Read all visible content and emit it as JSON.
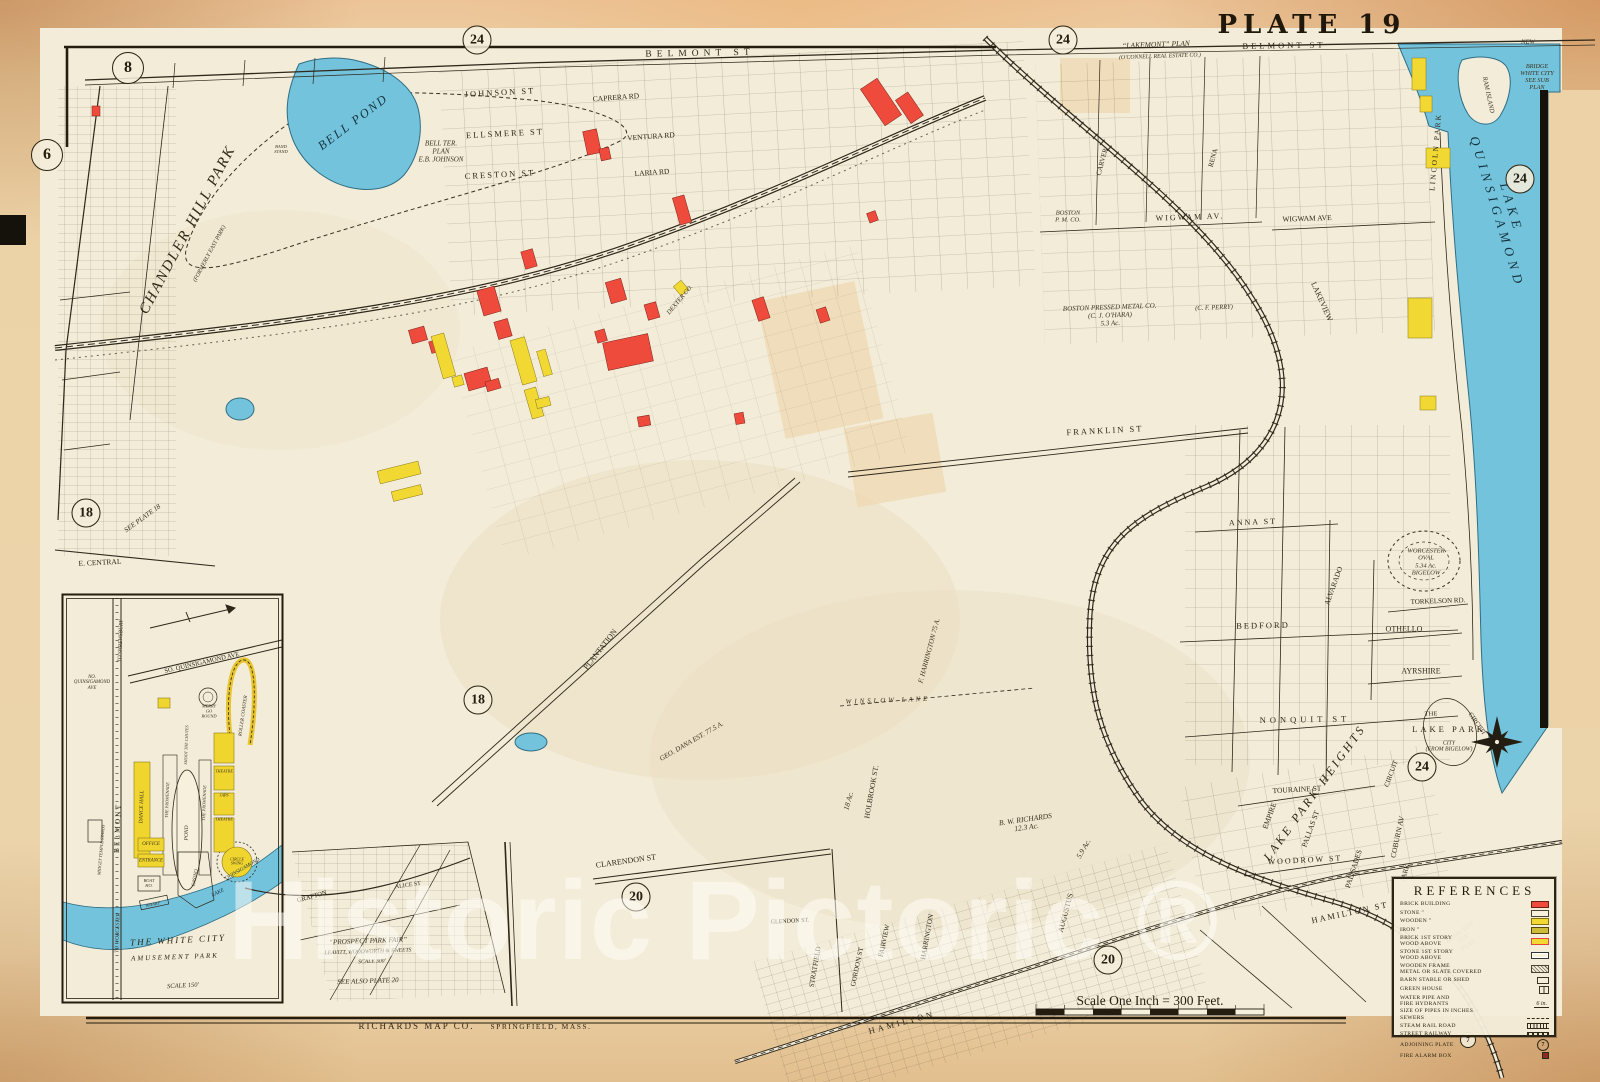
{
  "title": {
    "plate": "PLATE 19"
  },
  "watermark": "Historic Pictoric ®",
  "footer": {
    "publisher": "RICHARDS MAP CO.",
    "publisher_city": "SPRINGFIELD, MASS.",
    "scale": "Scale One Inch = 300 Feet."
  },
  "colors": {
    "paper": "#ecd2a6",
    "map_cream": "#f2ecd9",
    "water": "#74c3dc",
    "brick_red": "#ee4b3c",
    "wood_yellow": "#f2d832",
    "ink": "#2e271a"
  },
  "circled_plate_numbers": [
    {
      "n": "8",
      "x": 128,
      "y": 68,
      "d": 30
    },
    {
      "n": "6",
      "x": 47,
      "y": 155,
      "d": 30
    },
    {
      "n": "24",
      "x": 477,
      "y": 40,
      "d": 27
    },
    {
      "n": "24",
      "x": 1063,
      "y": 40,
      "d": 27
    },
    {
      "n": "24",
      "x": 1520,
      "y": 179,
      "d": 27
    },
    {
      "n": "18",
      "x": 86,
      "y": 513,
      "d": 27
    },
    {
      "n": "18",
      "x": 478,
      "y": 700,
      "d": 27
    },
    {
      "n": "20",
      "x": 636,
      "y": 897,
      "d": 27
    },
    {
      "n": "20",
      "x": 1108,
      "y": 960,
      "d": 27
    },
    {
      "n": "24",
      "x": 1422,
      "y": 767,
      "d": 27
    },
    {
      "n": "7",
      "x": 1468,
      "y": 1040,
      "d": 14
    }
  ],
  "legend": {
    "title": "REFERENCES",
    "plate_badge": "7",
    "pipe_text": "6 in.",
    "rows": [
      {
        "label": "BRICK BUILDING",
        "swatch": "brick"
      },
      {
        "label": "STONE ″",
        "swatch": "stone"
      },
      {
        "label": "WOODEN ″",
        "swatch": "wood"
      },
      {
        "label": "IRON ″",
        "swatch": "iron"
      },
      {
        "label": "BRICK 1ST STORY\nWOOD ABOVE",
        "swatch": "brick1"
      },
      {
        "label": "STONE 1ST STORY\nWOOD ABOVE",
        "swatch": "stone1"
      },
      {
        "label": "WOODEN FRAME\nMETAL OR SLATE COVERED",
        "swatch": "metal"
      },
      {
        "label": "BARN STABLE OR SHED",
        "swatch": "barn"
      },
      {
        "label": "GREEN HOUSE",
        "swatch": "greenhouse"
      },
      {
        "label": "WATER PIPE AND\nFIRE HYDRANTS\nSIZE OF PIPES IN INCHES",
        "swatch": "pipe"
      },
      {
        "label": "SEWERS",
        "swatch": "sewer"
      },
      {
        "label": "STEAM RAIL ROAD",
        "swatch": "steamrr"
      },
      {
        "label": "STREET RAILWAY",
        "swatch": "streetry"
      },
      {
        "label": "ADJOINING PLATE",
        "swatch": "plate"
      },
      {
        "label": "FIRE ALARM BOX",
        "swatch": "alarm"
      }
    ]
  },
  "labels": [
    {
      "t": "BELMONT ST",
      "x": 700,
      "y": 54,
      "r": -1,
      "s": 9.5,
      "c": "street",
      "sp": 5
    },
    {
      "t": "BELMONT ST",
      "x": 1284,
      "y": 46,
      "r": -1,
      "s": 8.5,
      "c": "street",
      "sp": 3
    },
    {
      "t": "JOHNSON ST",
      "x": 500,
      "y": 93,
      "r": -3,
      "s": 8.5,
      "c": "street",
      "sp": 2
    },
    {
      "t": "ELLSMERE ST",
      "x": 505,
      "y": 134,
      "r": -3,
      "s": 8.5,
      "c": "street",
      "sp": 2
    },
    {
      "t": "CRESTON ST",
      "x": 500,
      "y": 175,
      "r": -3,
      "s": 8.5,
      "c": "street",
      "sp": 2
    },
    {
      "t": "CAPRERA RD",
      "x": 616,
      "y": 98,
      "r": -4,
      "s": 7.5,
      "c": "street"
    },
    {
      "t": "VENTURA RD",
      "x": 651,
      "y": 137,
      "r": -4,
      "s": 7.5,
      "c": "street"
    },
    {
      "t": "LARIA RD",
      "x": 652,
      "y": 173,
      "r": -4,
      "s": 7.5,
      "c": "street"
    },
    {
      "t": "CARVER",
      "x": 1103,
      "y": 162,
      "r": -75,
      "s": 7,
      "c": "street"
    },
    {
      "t": "RENA",
      "x": 1214,
      "y": 158,
      "r": -75,
      "s": 7,
      "c": "street"
    },
    {
      "t": "WIGWAM AV.",
      "x": 1190,
      "y": 218,
      "r": -2,
      "s": 8,
      "c": "street",
      "sp": 2
    },
    {
      "t": "WIGWAM AVE",
      "x": 1307,
      "y": 219,
      "r": -2,
      "s": 7.5,
      "c": "street"
    },
    {
      "t": "LAKEVIEW",
      "x": 1321,
      "y": 302,
      "r": 66,
      "s": 8,
      "c": "street"
    },
    {
      "t": "FRANKLIN ST",
      "x": 1105,
      "y": 431,
      "r": -3,
      "s": 8.5,
      "c": "street",
      "sp": 2
    },
    {
      "t": "ANNA ST",
      "x": 1253,
      "y": 523,
      "r": -2,
      "s": 8,
      "c": "street",
      "sp": 2
    },
    {
      "t": "BEDFORD",
      "x": 1263,
      "y": 626,
      "r": -1,
      "s": 8.5,
      "c": "street",
      "sp": 2
    },
    {
      "t": "OTHELLO",
      "x": 1404,
      "y": 630,
      "r": 0,
      "s": 8,
      "c": "street"
    },
    {
      "t": "AYRSHIRE",
      "x": 1421,
      "y": 672,
      "r": 0,
      "s": 8,
      "c": "street"
    },
    {
      "t": "TORKELSON RD.",
      "x": 1438,
      "y": 602,
      "r": -2,
      "s": 7,
      "c": "street"
    },
    {
      "t": "NONQUIT ST",
      "x": 1305,
      "y": 720,
      "r": -1,
      "s": 8.5,
      "c": "street",
      "sp": 4
    },
    {
      "t": "TOURAINE ST",
      "x": 1297,
      "y": 790,
      "r": -3,
      "s": 7.5,
      "c": "street"
    },
    {
      "t": "WOODROW ST",
      "x": 1305,
      "y": 861,
      "r": -3,
      "s": 8,
      "c": "street",
      "sp": 2
    },
    {
      "t": "HAMILTON ST",
      "x": 1350,
      "y": 913,
      "r": -12,
      "s": 8.5,
      "c": "street",
      "sp": 2
    },
    {
      "t": "HAMILTON",
      "x": 902,
      "y": 1023,
      "r": -15,
      "s": 8.5,
      "c": "street",
      "sp": 3
    },
    {
      "t": "CLARENDON ST",
      "x": 626,
      "y": 862,
      "r": -8,
      "s": 8,
      "c": "street"
    },
    {
      "t": "E. CENTRAL",
      "x": 100,
      "y": 563,
      "r": -3,
      "s": 7.5,
      "c": "street"
    },
    {
      "t": "PLANTATION",
      "x": 601,
      "y": 650,
      "r": -52,
      "s": 8,
      "c": "street"
    },
    {
      "t": "HOLBROOK ST.",
      "x": 872,
      "y": 792,
      "r": -80,
      "s": 7.5,
      "c": "street"
    },
    {
      "t": "AUGUSTUS",
      "x": 1066,
      "y": 913,
      "r": -75,
      "s": 7.5,
      "c": "street"
    },
    {
      "t": "GORDON ST",
      "x": 858,
      "y": 967,
      "r": -78,
      "s": 7,
      "c": "street"
    },
    {
      "t": "FAIRVIEW",
      "x": 885,
      "y": 941,
      "r": -78,
      "s": 7,
      "c": "street"
    },
    {
      "t": "HARRINGTON",
      "x": 928,
      "y": 937,
      "r": -80,
      "s": 7,
      "c": "street"
    },
    {
      "t": "STRATFIELD",
      "x": 816,
      "y": 967,
      "r": -80,
      "s": 7,
      "c": "street"
    },
    {
      "t": "GLENDON ST.",
      "x": 790,
      "y": 922,
      "r": -3,
      "s": 6,
      "c": "street"
    },
    {
      "t": "EMPIRE",
      "x": 1270,
      "y": 816,
      "r": -70,
      "s": 7.5,
      "c": "street"
    },
    {
      "t": "PALLAS ST",
      "x": 1311,
      "y": 829,
      "r": -70,
      "s": 7.5,
      "c": "street"
    },
    {
      "t": "PALISADES",
      "x": 1354,
      "y": 869,
      "r": -72,
      "s": 7.5,
      "c": "street"
    },
    {
      "t": "COBURN AV",
      "x": 1398,
      "y": 837,
      "r": -78,
      "s": 7.5,
      "c": "street"
    },
    {
      "t": "CIRCUIT",
      "x": 1392,
      "y": 774,
      "r": -70,
      "s": 7,
      "c": "street"
    },
    {
      "t": "PARK",
      "x": 1406,
      "y": 873,
      "r": -75,
      "s": 7,
      "c": "street"
    },
    {
      "t": "ALVARADO",
      "x": 1334,
      "y": 586,
      "r": -70,
      "s": 7.5,
      "c": "street"
    },
    {
      "t": "LAKE PARK HEIGHTS",
      "x": 1315,
      "y": 793,
      "r": -54,
      "s": 12,
      "c": "area",
      "sp": 3
    },
    {
      "t": "LAKE PARK",
      "x": 1449,
      "y": 730,
      "r": 0,
      "s": 8.5,
      "c": "street",
      "sp": 3
    },
    {
      "t": "CITY\n(FROM BIGELOW)",
      "x": 1449,
      "y": 747,
      "r": 0,
      "s": 5.8,
      "c": "note"
    },
    {
      "t": "THE",
      "x": 1431,
      "y": 714,
      "r": 0,
      "s": 6.5,
      "c": "street"
    },
    {
      "t": "CIRCUIT",
      "x": 1477,
      "y": 724,
      "r": 55,
      "s": 6.5,
      "c": "street"
    },
    {
      "t": "WORCESTER\nOVAL\n5.34 Ac.\nBIGELOW",
      "x": 1426,
      "y": 562,
      "r": 0,
      "s": 6.5,
      "c": "note"
    },
    {
      "t": "BOSTON PRESSED METAL CO.\n(C. J. O'HARA)\n5.3 Ac.",
      "x": 1110,
      "y": 316,
      "r": -2,
      "s": 7,
      "c": "note"
    },
    {
      "t": "(C. F. PERRY)",
      "x": 1214,
      "y": 308,
      "r": -2,
      "s": 6.5,
      "c": "note"
    },
    {
      "t": "BOSTON\nP. M. CO.",
      "x": 1068,
      "y": 217,
      "r": 0,
      "s": 6.5,
      "c": "note"
    },
    {
      "t": "WINSLOW LANE",
      "x": 888,
      "y": 701,
      "r": -2,
      "s": 6.8,
      "c": "note",
      "sp": 3
    },
    {
      "t": "F. HARRINGTON  75 A.",
      "x": 930,
      "y": 651,
      "r": -75,
      "s": 7,
      "c": "note"
    },
    {
      "t": "GEO. DANA EST.  77.5 A.",
      "x": 692,
      "y": 742,
      "r": -30,
      "s": 7,
      "c": "note"
    },
    {
      "t": "18 Ac.",
      "x": 849,
      "y": 801,
      "r": -75,
      "s": 7.5,
      "c": "note"
    },
    {
      "t": "B. W. RICHARDS\n12.3 Ac.",
      "x": 1026,
      "y": 824,
      "r": -8,
      "s": 7.5,
      "c": "note"
    },
    {
      "t": "5.9 Ac.",
      "x": 1084,
      "y": 849,
      "r": -60,
      "s": 7.5,
      "c": "note"
    },
    {
      "t": "HAMILTON\nTER.\nPLAN",
      "x": 1464,
      "y": 939,
      "r": -35,
      "s": 6.5,
      "c": "note"
    },
    {
      "t": "BELL TER.\nPLAN\nE.B. JOHNSON",
      "x": 441,
      "y": 152,
      "r": 0,
      "s": 7,
      "c": "note"
    },
    {
      "t": "SEE PLATE 18",
      "x": 143,
      "y": 519,
      "r": -36,
      "s": 7,
      "c": "note"
    },
    {
      "t": "“LAKEMONT” PLAN",
      "x": 1156,
      "y": 45,
      "r": -2,
      "s": 7.5,
      "c": "note"
    },
    {
      "t": "(O'CONNELL REAL ESTATE CO.)",
      "x": 1160,
      "y": 57,
      "r": -2,
      "s": 5.8,
      "c": "note"
    },
    {
      "t": "NEW",
      "x": 1528,
      "y": 42,
      "r": 0,
      "s": 6.5,
      "c": "note"
    },
    {
      "t": "BRIDGE\nWHITE CITY\nSEE SUB\nPLAN",
      "x": 1537,
      "y": 78,
      "r": 0,
      "s": 6.2,
      "c": "note"
    },
    {
      "t": "RAM ISLAND",
      "x": 1488,
      "y": 95,
      "r": 78,
      "s": 6.5,
      "c": "note"
    },
    {
      "t": "LINCOLN PARK",
      "x": 1436,
      "y": 152,
      "r": -85,
      "s": 7.5,
      "c": "street",
      "sp": 2
    },
    {
      "t": "CHANDLER HILL PARK",
      "x": 188,
      "y": 230,
      "r": -62,
      "s": 15,
      "c": "area",
      "sp": 2
    },
    {
      "t": "(FORMERLY EAST PARK)",
      "x": 210,
      "y": 254,
      "r": -62,
      "s": 5.8,
      "c": "note"
    },
    {
      "t": "BELL POND",
      "x": 353,
      "y": 122,
      "r": -37,
      "s": 12.5,
      "c": "water",
      "sp": 2
    },
    {
      "t": "BAND\nSTAND",
      "x": 281,
      "y": 149,
      "r": 0,
      "s": 4.5,
      "c": "note"
    },
    {
      "t": "LAKE QUINSIGAMOND",
      "x": 1504,
      "y": 210,
      "r": 73,
      "s": 13,
      "c": "water",
      "sp": 5
    },
    {
      "t": "DEXTER CO.",
      "x": 680,
      "y": 300,
      "r": -50,
      "s": 6.5,
      "c": "note"
    },
    {
      "t": "“PROSPECT PARK FAIR”",
      "x": 368,
      "y": 941,
      "r": -2,
      "s": 7.2,
      "c": "note"
    },
    {
      "t": "LEAVITT, WOODWORTH & SWEETS",
      "x": 368,
      "y": 952,
      "r": -2,
      "s": 5.6,
      "c": "note"
    },
    {
      "t": "SCALE 300'",
      "x": 372,
      "y": 962,
      "r": -2,
      "s": 5.6,
      "c": "note"
    },
    {
      "t": "SEE ALSO PLATE 20",
      "x": 368,
      "y": 982,
      "r": -2,
      "s": 7,
      "c": "note"
    },
    {
      "t": "GRAFTON",
      "x": 312,
      "y": 897,
      "r": -16,
      "s": 6.5,
      "c": "street"
    },
    {
      "t": "ALICE ST",
      "x": 408,
      "y": 886,
      "r": -8,
      "s": 6,
      "c": "street"
    },
    {
      "t": "SO. QUINSIGAMOND AVE",
      "x": 202,
      "y": 663,
      "r": -13,
      "s": 6.5,
      "c": "street"
    },
    {
      "t": "NO.\nQUINSIGAMOND\nAVE",
      "x": 92,
      "y": 683,
      "r": 0,
      "s": 4.8,
      "c": "note"
    },
    {
      "t": "TO SHREWSBURY",
      "x": 121,
      "y": 641,
      "r": -88,
      "s": 5.5,
      "c": "note"
    },
    {
      "t": "BELMONT",
      "x": 118,
      "y": 828,
      "r": -88,
      "s": 7.5,
      "c": "street",
      "sp": 2
    },
    {
      "t": "TO WORCESTER",
      "x": 118,
      "y": 933,
      "r": -88,
      "s": 5.5,
      "c": "note"
    },
    {
      "t": "MERRY\nGO\nROUND",
      "x": 209,
      "y": 712,
      "r": 0,
      "s": 4.4,
      "c": "note"
    },
    {
      "t": "ROLLER COASTER",
      "x": 244,
      "y": 716,
      "r": -82,
      "s": 5,
      "c": "note"
    },
    {
      "t": "DANCE HALL",
      "x": 142,
      "y": 807,
      "r": -88,
      "s": 5.5,
      "c": "note"
    },
    {
      "t": "THE PROMENADE",
      "x": 168,
      "y": 800,
      "r": -88,
      "s": 4.4,
      "c": "note"
    },
    {
      "t": "POND",
      "x": 187,
      "y": 833,
      "r": -88,
      "s": 5.5,
      "c": "note"
    },
    {
      "t": "THE PROMENADE",
      "x": 205,
      "y": 803,
      "r": -88,
      "s": 4.4,
      "c": "note"
    },
    {
      "t": "SHOOT THE CHUTES",
      "x": 187,
      "y": 745,
      "r": -88,
      "s": 4.2,
      "c": "note"
    },
    {
      "t": "THEATRE",
      "x": 224,
      "y": 772,
      "r": 0,
      "s": 4.2,
      "c": "note"
    },
    {
      "t": "JAPS",
      "x": 224,
      "y": 796,
      "r": 0,
      "s": 4.2,
      "c": "note"
    },
    {
      "t": "THEATRE",
      "x": 224,
      "y": 820,
      "r": 0,
      "s": 4.2,
      "c": "note"
    },
    {
      "t": "CIRCLE\nSWING",
      "x": 237,
      "y": 862,
      "r": 0,
      "s": 4,
      "c": "note"
    },
    {
      "t": "OFFICE",
      "x": 151,
      "y": 845,
      "r": 0,
      "s": 5,
      "c": "note"
    },
    {
      "t": "ENTRANCE",
      "x": 151,
      "y": 861,
      "r": 0,
      "s": 4.8,
      "c": "note"
    },
    {
      "t": "BOAT\nHO.",
      "x": 149,
      "y": 884,
      "r": 0,
      "s": 4.4,
      "c": "note"
    },
    {
      "t": "WHARF",
      "x": 153,
      "y": 905,
      "r": -12,
      "s": 4.4,
      "c": "note"
    },
    {
      "t": "CASINO",
      "x": 196,
      "y": 878,
      "r": -80,
      "s": 5,
      "c": "note"
    },
    {
      "t": "MIDGET TEMPLE STANDS",
      "x": 102,
      "y": 850,
      "r": -85,
      "s": 4.4,
      "c": "note"
    },
    {
      "t": "LAKE",
      "x": 218,
      "y": 893,
      "r": -25,
      "s": 5.5,
      "c": "water"
    },
    {
      "t": "QUINSIGAMOND",
      "x": 243,
      "y": 870,
      "r": -30,
      "s": 5.2,
      "c": "water"
    },
    {
      "t": "THE WHITE CITY",
      "x": 178,
      "y": 940,
      "r": -3,
      "s": 9,
      "c": "area",
      "sp": 2
    },
    {
      "t": "AMUSEMENT PARK",
      "x": 175,
      "y": 958,
      "r": -2,
      "s": 7,
      "c": "area",
      "sp": 2
    },
    {
      "t": "SCALE 150'",
      "x": 183,
      "y": 986,
      "r": -3,
      "s": 6.5,
      "c": "note"
    }
  ]
}
